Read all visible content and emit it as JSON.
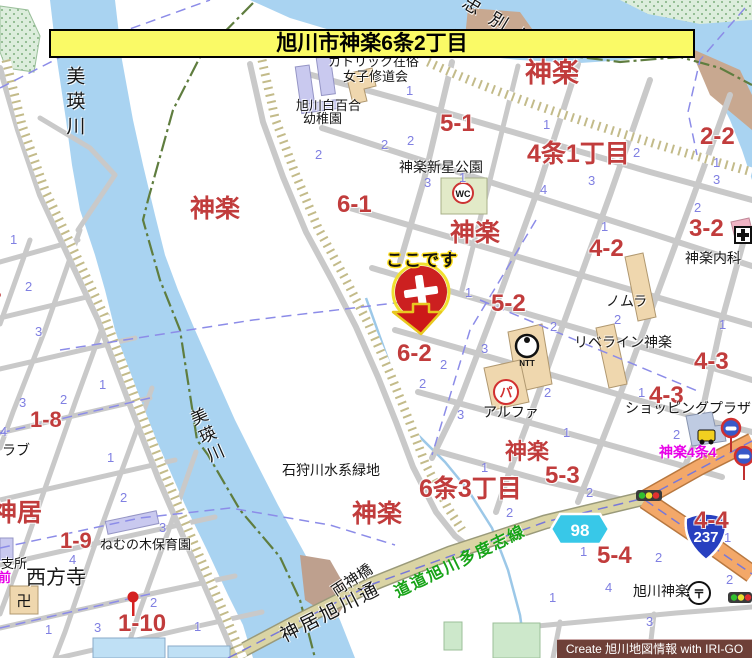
{
  "banner": {
    "title": "旭川市神楽6条2丁目"
  },
  "marker": {
    "label": "ここです"
  },
  "watermark": {
    "text": "Create 旭川地図情報 with IRI-GO"
  },
  "route_shields": {
    "prefectural": "98",
    "national": "237"
  },
  "icons": {
    "wc": "WC",
    "ntt": "NTT",
    "parking": "パ",
    "temple_manji": "卍",
    "post_mark": "〒",
    "hospital_cross": "+"
  },
  "colors": {
    "water": "#A9D3F1",
    "road_orange": "#F3A869",
    "road_beige": "#D9D3A3",
    "label_red": "#C13C3C",
    "label_blue": "#8080E2",
    "banner_yellow": "#FAFA66",
    "marker_red": "#CC2020",
    "boundary_green": "#5F7D3F",
    "magenta": "#E800E8"
  },
  "red_labels": [
    {
      "text": "神楽",
      "x": 525,
      "y": 60,
      "size": 27
    },
    {
      "text": "神楽",
      "x": 190,
      "y": 197,
      "size": 25
    },
    {
      "text": "神楽",
      "x": 450,
      "y": 221,
      "size": 25
    },
    {
      "text": "神楽",
      "x": 352,
      "y": 502,
      "size": 25
    },
    {
      "text": "神楽",
      "x": 505,
      "y": 441,
      "size": 22
    },
    {
      "text": "神居",
      "x": -8,
      "y": 501,
      "size": 25
    },
    {
      "text": "5-1",
      "x": 440,
      "y": 112,
      "size": 24
    },
    {
      "text": "6-1",
      "x": 337,
      "y": 193,
      "size": 24
    },
    {
      "text": "4条1丁目",
      "x": 527,
      "y": 142,
      "size": 25
    },
    {
      "text": "2-2",
      "x": 700,
      "y": 125,
      "size": 24
    },
    {
      "text": "3-2",
      "x": 689,
      "y": 217,
      "size": 24
    },
    {
      "text": "4-2",
      "x": 589,
      "y": 237,
      "size": 24
    },
    {
      "text": "5-2",
      "x": 491,
      "y": 292,
      "size": 24
    },
    {
      "text": "6-2",
      "x": 397,
      "y": 342,
      "size": 24
    },
    {
      "text": "4-3",
      "x": 694,
      "y": 350,
      "size": 24
    },
    {
      "text": "4-3",
      "x": 649,
      "y": 384,
      "size": 24
    },
    {
      "text": "6条3丁目",
      "x": 419,
      "y": 477,
      "size": 25
    },
    {
      "text": "5-3",
      "x": 545,
      "y": 464,
      "size": 24
    },
    {
      "text": "5-4",
      "x": 597,
      "y": 544,
      "size": 24
    },
    {
      "text": "4-4",
      "x": 694,
      "y": 509,
      "size": 24
    },
    {
      "text": "1-8",
      "x": 30,
      "y": 409,
      "size": 22
    },
    {
      "text": "1-9",
      "x": 60,
      "y": 530,
      "size": 22
    },
    {
      "text": "1-10",
      "x": 118,
      "y": 612,
      "size": 24
    },
    {
      "text": "1-7",
      "x": -30,
      "y": 291,
      "size": 22
    }
  ],
  "black_labels": [
    {
      "text": "カトリック在俗",
      "x": 328,
      "y": 55,
      "size": 13
    },
    {
      "text": "女子修道会",
      "x": 343,
      "y": 70,
      "size": 13
    },
    {
      "text": "旭川白百合",
      "x": 296,
      "y": 99,
      "size": 13
    },
    {
      "text": "幼稚園",
      "x": 303,
      "y": 112,
      "size": 13
    },
    {
      "text": "神楽新星公園",
      "x": 399,
      "y": 162,
      "size": 14,
      "serif": true
    },
    {
      "text": "神楽内科",
      "x": 685,
      "y": 251,
      "size": 14
    },
    {
      "text": "ノムラ",
      "x": 606,
      "y": 294,
      "size": 14
    },
    {
      "text": "リベライン神楽",
      "x": 574,
      "y": 335,
      "size": 14
    },
    {
      "text": "アルファ",
      "x": 483,
      "y": 405,
      "size": 14
    },
    {
      "text": "ショッピングプラザ",
      "x": 625,
      "y": 401,
      "size": 14
    },
    {
      "text": "石狩川水系緑地",
      "x": 282,
      "y": 465,
      "size": 14,
      "serif": true
    },
    {
      "text": "ねむの木保育園",
      "x": 100,
      "y": 538,
      "size": 13
    },
    {
      "text": "西方寺",
      "x": 26,
      "y": 568,
      "size": 20,
      "serif": true
    },
    {
      "text": "支所",
      "x": 1,
      "y": 557,
      "size": 13
    },
    {
      "text": "ラブ",
      "x": 2,
      "y": 443,
      "size": 14
    },
    {
      "text": "旭川神楽",
      "x": 633,
      "y": 584,
      "size": 14
    },
    {
      "text": "両神橋",
      "x": 334,
      "y": 586,
      "size": 15,
      "rot": -33,
      "serif": true
    },
    {
      "text": "神居旭川通",
      "x": 282,
      "y": 628,
      "size": 19,
      "rot": -27,
      "ls": 3,
      "serif": true
    },
    {
      "text": "忠別川",
      "x": 464,
      "y": -8,
      "size": 18,
      "rot": 31,
      "ls": 13,
      "serif": true
    },
    {
      "text": "美瑛川",
      "x": 64,
      "y": 66,
      "size": 19,
      "vertical": true,
      "ls": 6,
      "serif": true
    },
    {
      "text": "美瑛川",
      "x": 198,
      "y": 410,
      "size": 17,
      "vertical": true,
      "rot": -24,
      "ls": 3,
      "serif": true
    },
    {
      "text": "せせらぎ",
      "x": 640,
      "y": 645,
      "size": 14
    }
  ],
  "green_labels": [
    {
      "text": "道道旭川多度志線",
      "x": 396,
      "y": 586,
      "size": 16,
      "rot": -26,
      "ls": 2
    }
  ],
  "magenta_labels": [
    {
      "text": "神楽4条4",
      "x": 659,
      "y": 445,
      "size": 14
    },
    {
      "text": "前",
      "x": -2,
      "y": 571,
      "size": 13
    }
  ],
  "blue_numbers": [
    {
      "n": "1",
      "x": 406,
      "y": 84
    },
    {
      "n": "2",
      "x": 381,
      "y": 138
    },
    {
      "n": "3",
      "x": 424,
      "y": 176
    },
    {
      "n": "2",
      "x": 315,
      "y": 148
    },
    {
      "n": "2",
      "x": 407,
      "y": 134
    },
    {
      "n": "1",
      "x": 543,
      "y": 118
    },
    {
      "n": "4",
      "x": 540,
      "y": 183
    },
    {
      "n": "3",
      "x": 588,
      "y": 174
    },
    {
      "n": "2",
      "x": 633,
      "y": 146
    },
    {
      "n": "1",
      "x": 713,
      "y": 156
    },
    {
      "n": "2",
      "x": 694,
      "y": 201
    },
    {
      "n": "3",
      "x": 713,
      "y": 173
    },
    {
      "n": "1",
      "x": 459,
      "y": 171
    },
    {
      "n": "4",
      "x": 446,
      "y": 248
    },
    {
      "n": "1",
      "x": 465,
      "y": 286
    },
    {
      "n": "2",
      "x": 614,
      "y": 313
    },
    {
      "n": "2",
      "x": 550,
      "y": 320
    },
    {
      "n": "3",
      "x": 481,
      "y": 342
    },
    {
      "n": "2",
      "x": 440,
      "y": 358
    },
    {
      "n": "2",
      "x": 419,
      "y": 377
    },
    {
      "n": "2",
      "x": 544,
      "y": 386
    },
    {
      "n": "3",
      "x": 457,
      "y": 408
    },
    {
      "n": "1",
      "x": 563,
      "y": 426
    },
    {
      "n": "1",
      "x": 601,
      "y": 220
    },
    {
      "n": "2",
      "x": 673,
      "y": 428
    },
    {
      "n": "1",
      "x": 719,
      "y": 318
    },
    {
      "n": "1",
      "x": 638,
      "y": 386
    },
    {
      "n": "1",
      "x": 481,
      "y": 461
    },
    {
      "n": "2",
      "x": 586,
      "y": 486
    },
    {
      "n": "2",
      "x": 506,
      "y": 506
    },
    {
      "n": "1",
      "x": 580,
      "y": 545
    },
    {
      "n": "2",
      "x": 655,
      "y": 551
    },
    {
      "n": "4",
      "x": 605,
      "y": 581
    },
    {
      "n": "1",
      "x": 549,
      "y": 591
    },
    {
      "n": "3",
      "x": 646,
      "y": 615
    },
    {
      "n": "1",
      "x": 724,
      "y": 531
    },
    {
      "n": "2",
      "x": 726,
      "y": 573
    },
    {
      "n": "1",
      "x": 10,
      "y": 233
    },
    {
      "n": "2",
      "x": 25,
      "y": 280
    },
    {
      "n": "3",
      "x": 35,
      "y": 325
    },
    {
      "n": "1",
      "x": 99,
      "y": 378
    },
    {
      "n": "2",
      "x": 60,
      "y": 393
    },
    {
      "n": "3",
      "x": 19,
      "y": 396
    },
    {
      "n": "4",
      "x": 0,
      "y": 425
    },
    {
      "n": "1",
      "x": 107,
      "y": 451
    },
    {
      "n": "2",
      "x": 120,
      "y": 491
    },
    {
      "n": "3",
      "x": 159,
      "y": 521
    },
    {
      "n": "4",
      "x": 69,
      "y": 553
    },
    {
      "n": "1",
      "x": 45,
      "y": 623
    },
    {
      "n": "3",
      "x": 94,
      "y": 621
    },
    {
      "n": "2",
      "x": 150,
      "y": 596
    },
    {
      "n": "1",
      "x": 194,
      "y": 620
    }
  ]
}
